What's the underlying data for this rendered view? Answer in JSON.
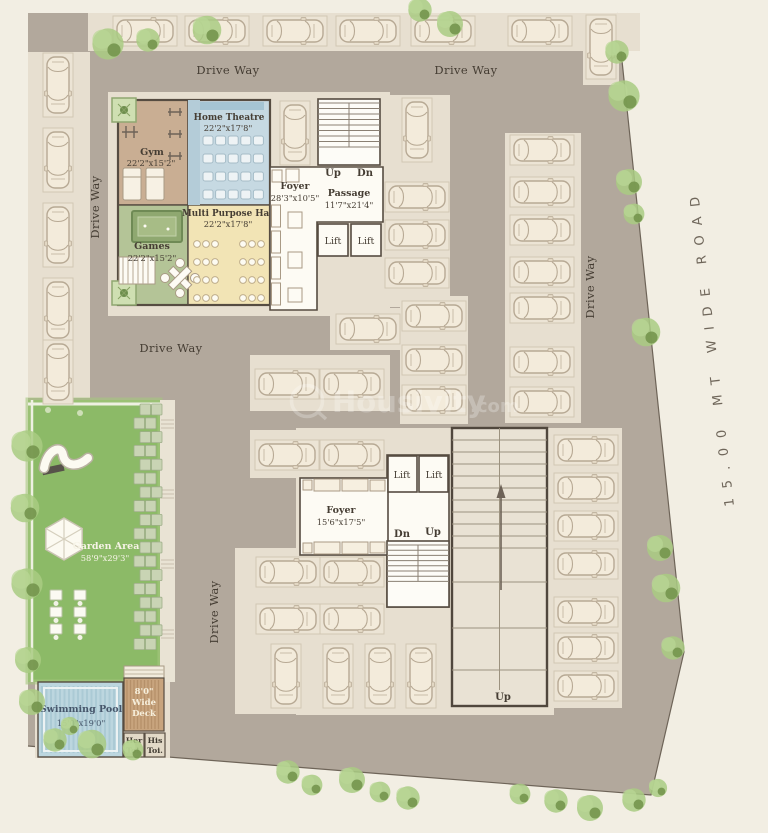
{
  "road": {
    "label": "15.00 MT WIDE ROAD"
  },
  "watermark": {
    "name": "Housivity",
    "suffix": ".com"
  },
  "labels": {
    "drive_way": "Drive Way",
    "lift": "Lift",
    "up": "Up",
    "dn": "Dn"
  },
  "rooms": {
    "gym": {
      "name": "Gym",
      "dim": "22'2\"x15'2\""
    },
    "home_theatre": {
      "name": "Home Theatre",
      "dim": "22'2\"x17'8\""
    },
    "games": {
      "name": "Games",
      "dim": "22'2\"x15'2\""
    },
    "multi_purpose_hall": {
      "name": "Multi Purpose Hall",
      "dim": "22'2\"x17'8\""
    },
    "foyer_upper": {
      "name": "Foyer",
      "dim": "28'3\"x10'5\""
    },
    "passage": {
      "name": "Passage",
      "dim": "11'7\"x21'4\""
    },
    "foyer_lower": {
      "name": "Foyer",
      "dim": "15'6\"x17'5\""
    },
    "garden": {
      "name": "Garden Area",
      "dim": "58'9\"x29'3\""
    },
    "pool": {
      "name": "Swimming Pool",
      "dim": "15'0\"x19'0\""
    },
    "deck": {
      "l1": "8'0\"",
      "l2": "Wide",
      "l3": "Deck"
    },
    "toilet_her": {
      "l1": "Her",
      "l2": "Toi."
    },
    "toilet_his": {
      "l1": "His",
      "l2": "Toi."
    }
  },
  "colors": {
    "road_bg": "#f2eee3",
    "site_ground": "#b2a89c",
    "parking_pad": "#e7dfd0",
    "gym": "#c9ae93",
    "home_theatre": "#c6d9e2",
    "games": "#b4c497",
    "multi_purpose_hall": "#f2e4b5",
    "garden": "#8cba67",
    "pool": "#bcd6df",
    "deck": "#c8a47e",
    "tree": "#a9cb82",
    "wall": "#564c41"
  }
}
